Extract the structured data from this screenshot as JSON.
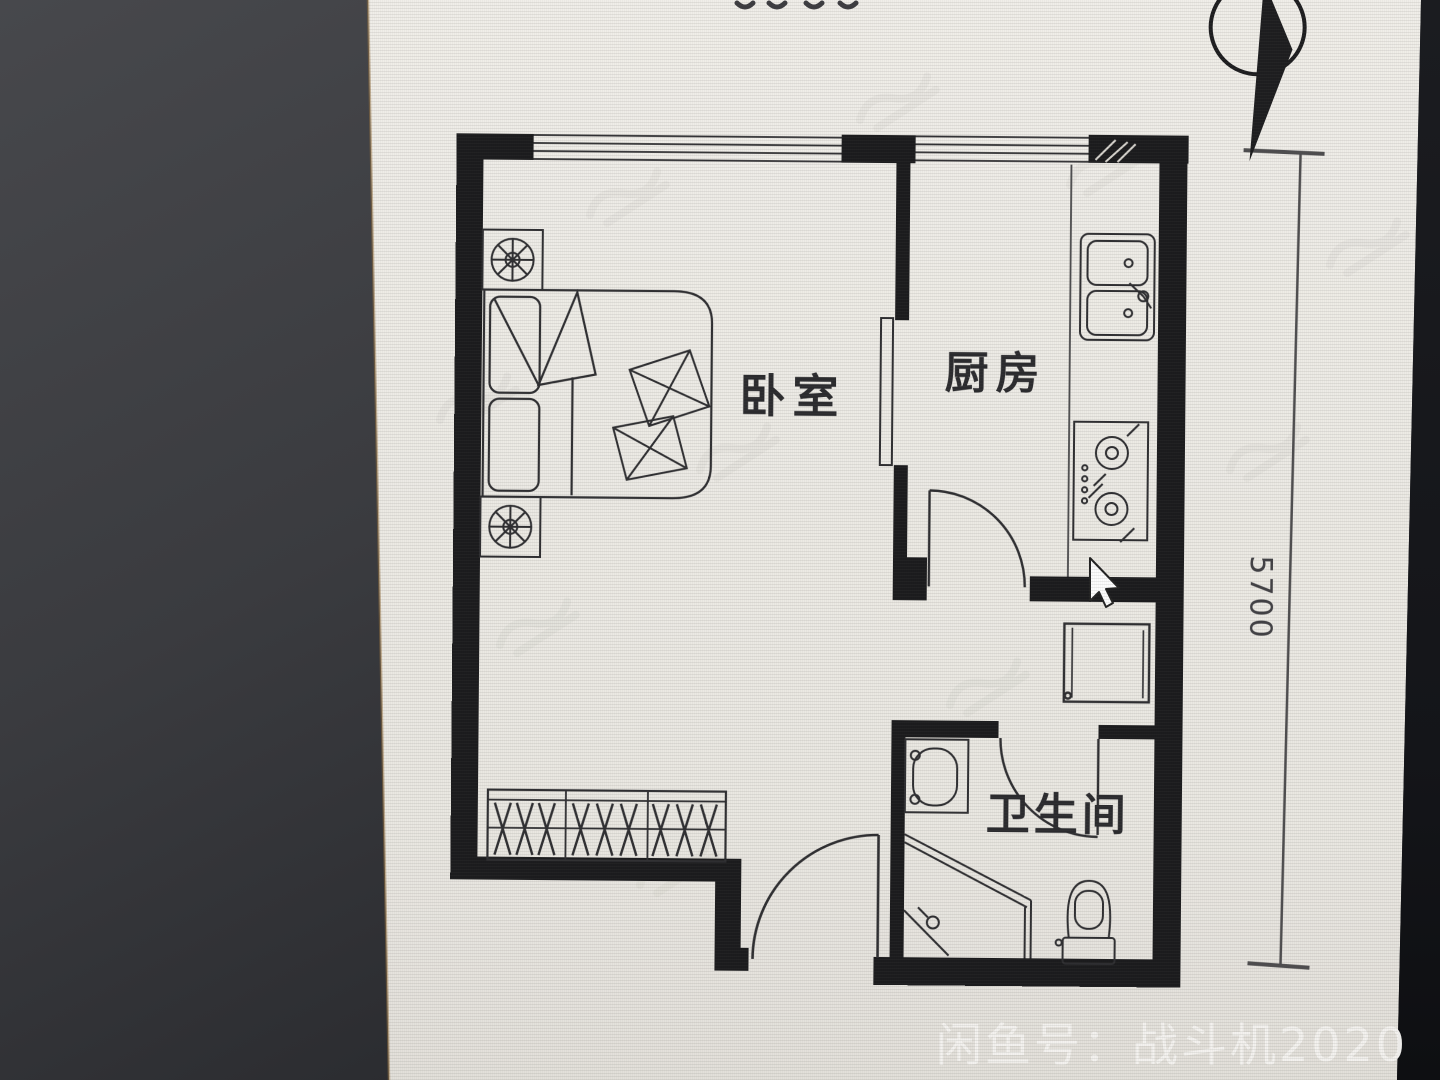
{
  "plan": {
    "labels": {
      "bedroom": "卧室",
      "kitchen": "厨房",
      "bathroom": "卫生间"
    },
    "dimension_right": "5700",
    "compass": "north-arrow",
    "furniture_icons": [
      "double-bed",
      "pillows",
      "nightstand-lamp",
      "folded-quilt",
      "wardrobe-hangers",
      "kitchen-sink",
      "gas-stove",
      "refrigerator",
      "washbasin",
      "corner-shower",
      "toilet"
    ],
    "cursor": "mouse-pointer"
  },
  "overlay": {
    "watermark_text": "闲鱼号：战斗机2020"
  },
  "colors": {
    "background_left": "#3e3f43",
    "background_right": "#17181c",
    "photo_white": "#edebe5",
    "plan_ink": "#1b1b1d",
    "watermark_white": "#f4f3f0"
  }
}
